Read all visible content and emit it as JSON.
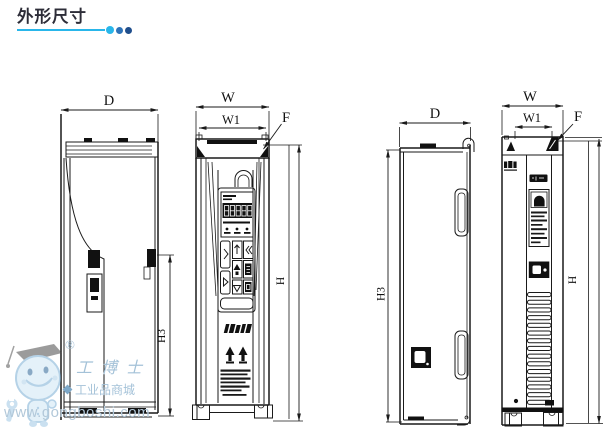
{
  "header": {
    "title": "外形尺寸"
  },
  "views": {
    "small_side": {
      "label_d": "D",
      "label_h3": "H3"
    },
    "small_front": {
      "label_w": "W",
      "label_w1": "W1",
      "label_f": "F",
      "label_h": "H"
    },
    "large_side": {
      "label_d": "D",
      "label_h3": "H3"
    },
    "large_front": {
      "label_w": "W",
      "label_w1": "W1",
      "label_f": "F",
      "label_h": "H"
    }
  },
  "watermark": {
    "registered": "®",
    "brand": "工博士",
    "tagline": "工业品商城",
    "url": "www.gongboshi.com"
  },
  "colors": {
    "accent": "#29b6ea",
    "dot_mid": "#2e73b8",
    "dot_dark": "#1f4e8c",
    "ink": "#1a1a1a",
    "watermark_blue": "#a4c2d8"
  }
}
